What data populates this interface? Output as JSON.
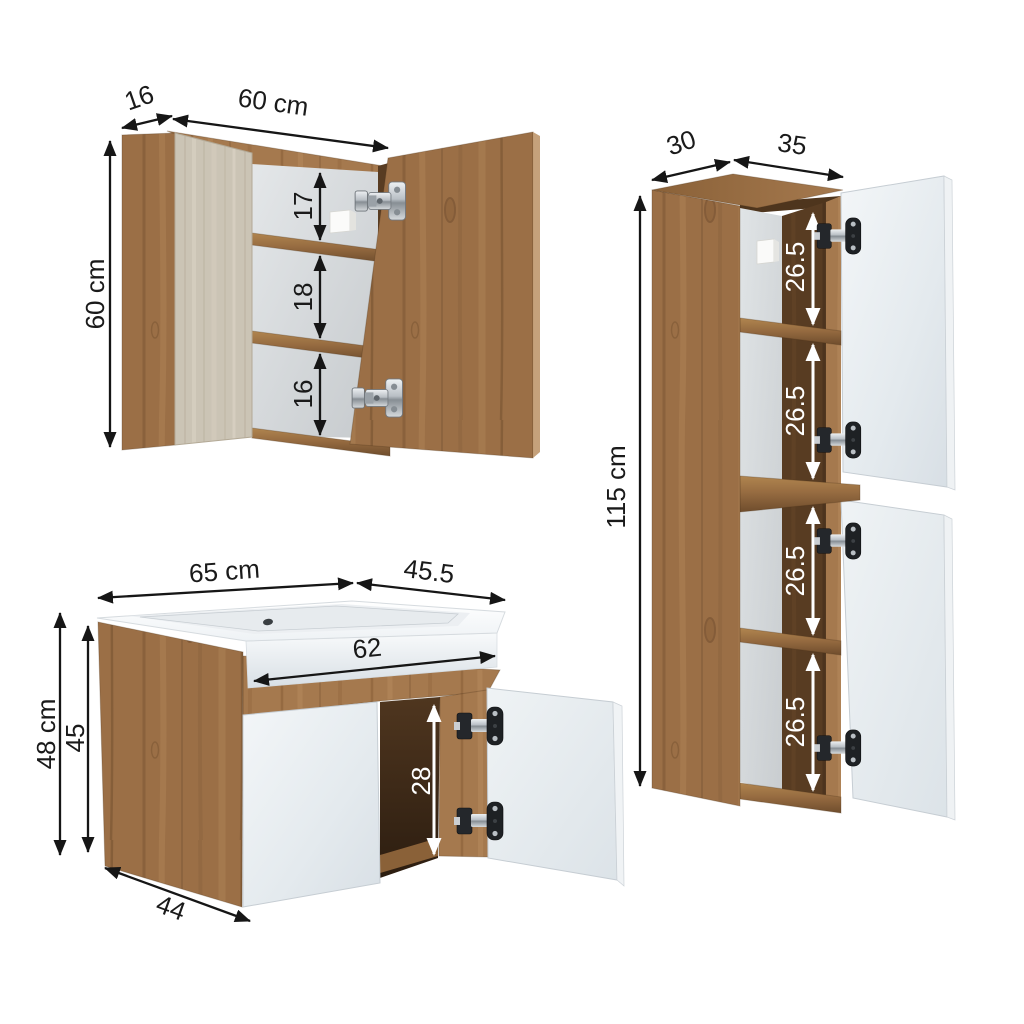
{
  "diagram": {
    "background": "#ffffff",
    "arrow_color": "#161616",
    "arrow_color_light": "#ffffff",
    "wood_color": "#9b6f46",
    "wood_dark_color": "#583c22",
    "door_color": "#e8edf1",
    "mirror_panel_color": "#cbc4b5"
  },
  "mirror_cabinet": {
    "width": "60 cm",
    "height": "60 cm",
    "depth": "16",
    "shelf_heights": [
      "17",
      "18",
      "16"
    ]
  },
  "vanity": {
    "width": "65 cm",
    "depth": "45.5",
    "basin_width": "62",
    "height": "48 cm",
    "body_height": "45",
    "opening_height": "28",
    "bottom_depth": "44"
  },
  "tall_cabinet": {
    "depth": "30",
    "width": "35",
    "height": "115 cm",
    "section_heights": [
      "26.5",
      "26.5",
      "26.5",
      "26.5"
    ]
  }
}
